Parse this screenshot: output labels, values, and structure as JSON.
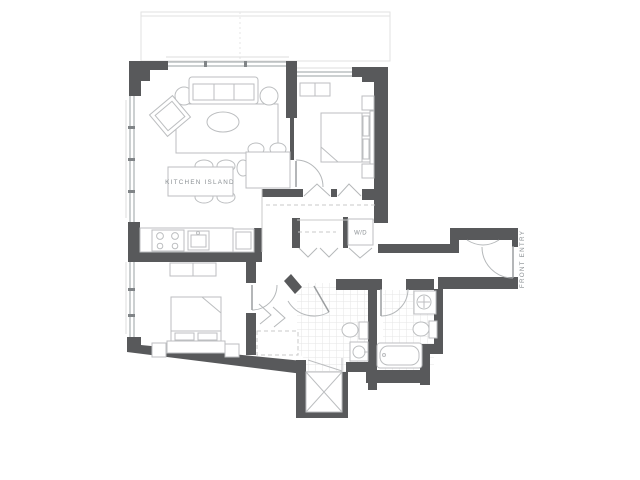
{
  "title": "Two bedroom apartment floor plan",
  "labels": {
    "kitchen_island": "KITCHEN ISLAND",
    "washer_dryer": "W/D",
    "front_entry": "FRONT ENTRY"
  },
  "colors": {
    "background": "#ffffff",
    "wall": "#58595b",
    "fixture_line": "#bcbec0",
    "tile_line": "#e6e6e6",
    "dashed_line": "#c9c9c9",
    "label_text": "#8a8f93"
  }
}
